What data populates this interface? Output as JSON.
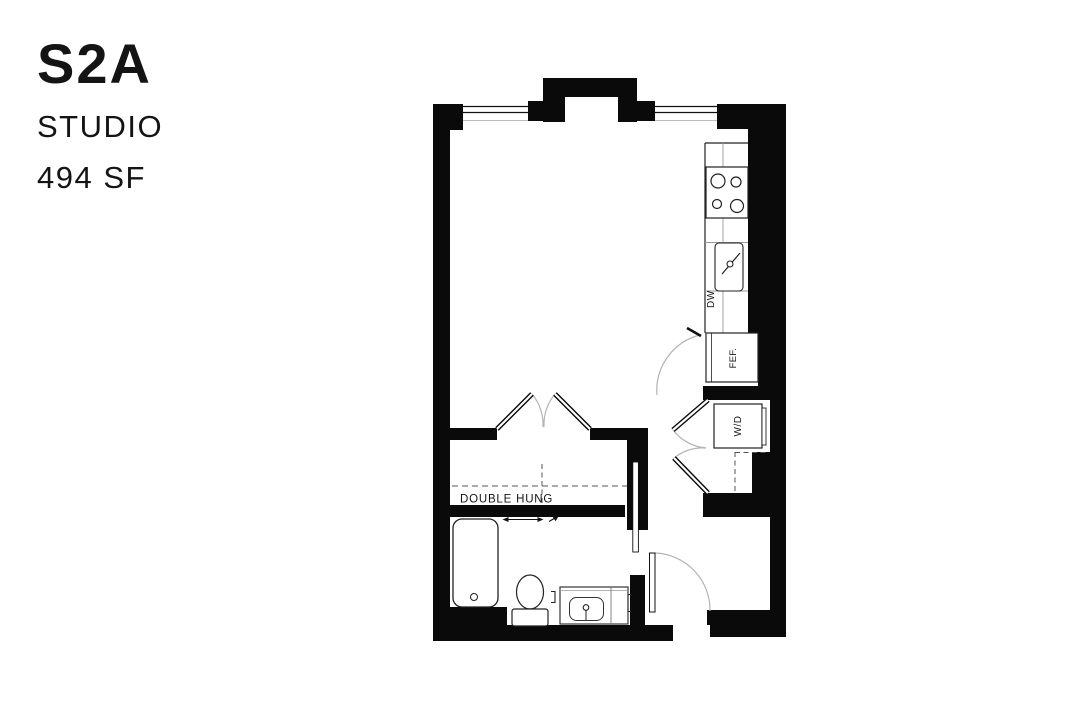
{
  "title": {
    "code": "S2A",
    "type": "STUDIO",
    "area": "494 SF"
  },
  "labels": {
    "closet_rod": "DOUBLE HUNG",
    "dishwasher": "DW",
    "refrigerator": "FEF.",
    "washer_dryer": "W/D"
  },
  "colors": {
    "wall": "#0a0a0a",
    "fixture_stroke": "#222222",
    "detail_line": "#999999",
    "door_arc": "#b3b3b3",
    "text": "#141414"
  }
}
